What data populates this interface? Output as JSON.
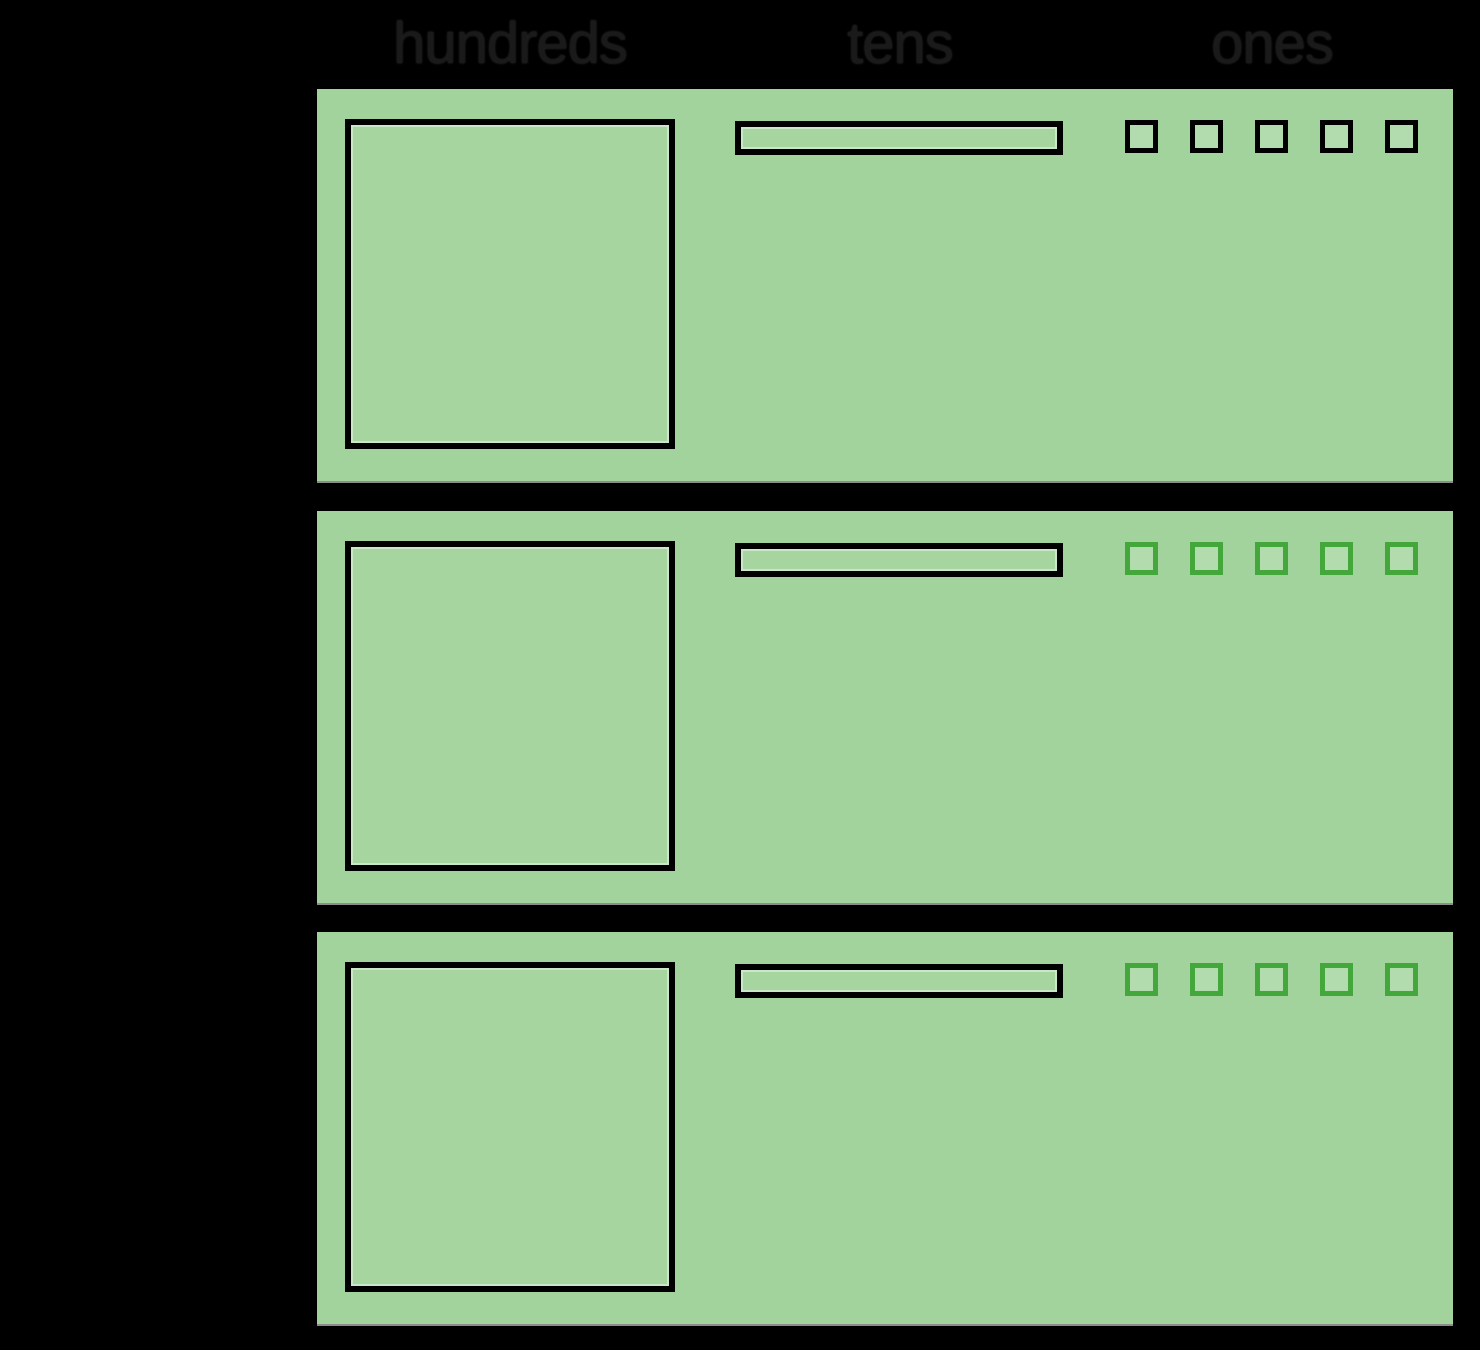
{
  "columns": [
    {
      "label": "hundreds"
    },
    {
      "label": "tens"
    },
    {
      "label": "ones"
    }
  ],
  "rows": [
    {
      "hundreds": 1,
      "tens": 1,
      "ones": 5,
      "ones_outline": "black"
    },
    {
      "hundreds": 1,
      "tens": 1,
      "ones": 5,
      "ones_outline": "green"
    },
    {
      "hundreds": 1,
      "tens": 1,
      "ones": 5,
      "ones_outline": "green"
    }
  ],
  "colors": {
    "background": "#000000",
    "panel_green": "#a3d39c",
    "block_fill": "#a6d5a0",
    "ones_fill": "#b3dcae",
    "outline_black": "#000000",
    "ones_green_outline": "#44a73c",
    "header_text": "#1a1a1a"
  }
}
